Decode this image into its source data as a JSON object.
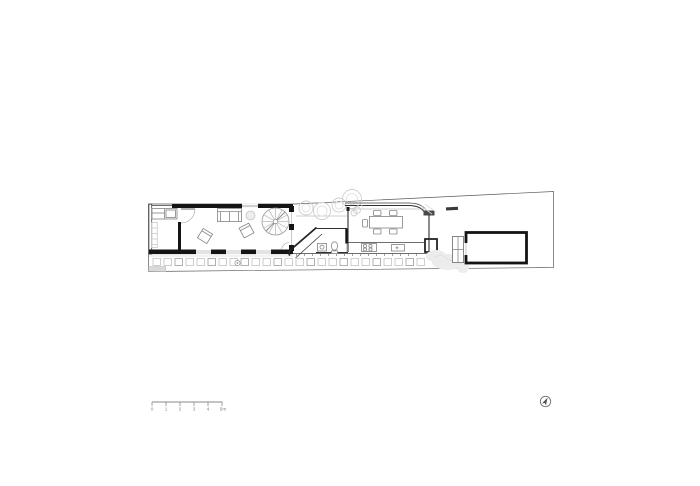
{
  "drawing": {
    "kind_label": "site floor plan",
    "background": "#ffffff"
  },
  "colors": {
    "ink_wall": "#141414",
    "line": "#3f3f3f",
    "furniture": "#8a8a8a",
    "foliage": "#cfcfcf",
    "paver": "#b9b9b9",
    "scale_text": "#808080"
  },
  "scale_bar": {
    "labels": [
      "0",
      "1",
      "2",
      "3",
      "4",
      "5m"
    ]
  },
  "north_arrow": {
    "icon": "north-arrow-icon"
  }
}
